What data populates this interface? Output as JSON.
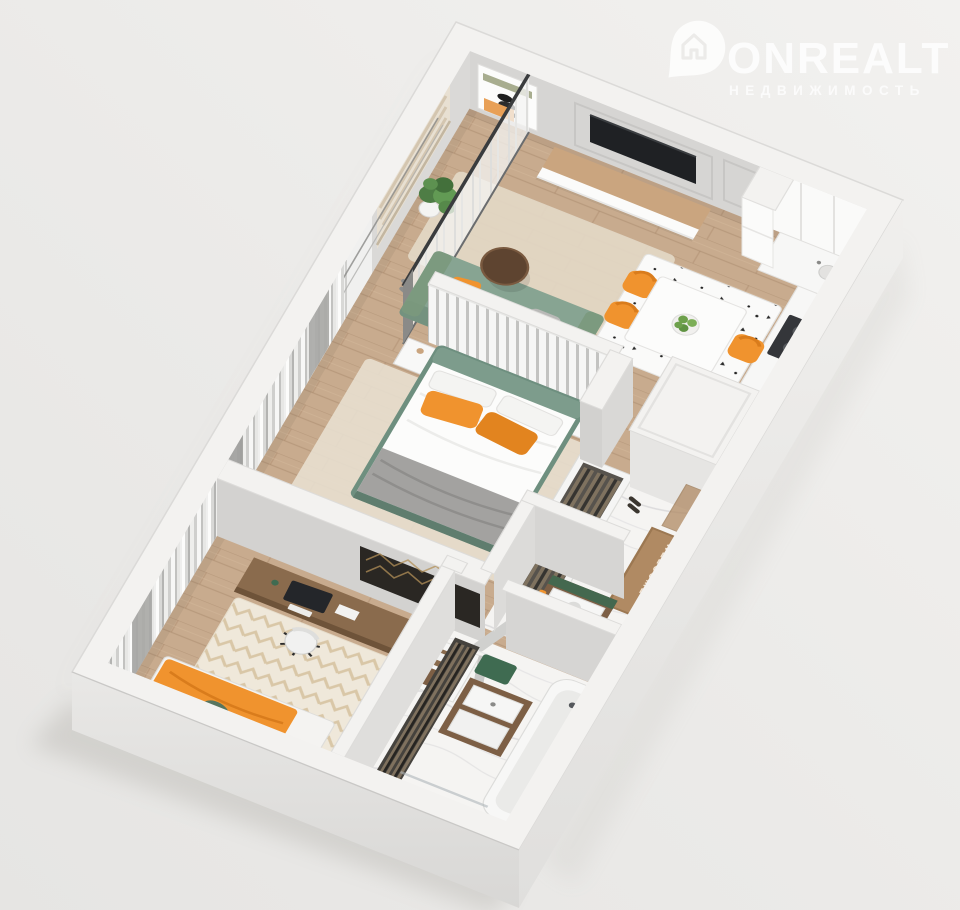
{
  "watermark": {
    "brand": "ONREALT",
    "tagline": "НЕДВИЖИМОСТЬ",
    "icon": "house-pin-icon"
  },
  "labels": {
    "doormat": "WELCOME",
    "doormat_reflection": "WELCOME"
  },
  "scene": {
    "type": "3d-floor-plan-render",
    "view": "isometric top-down, rotated",
    "background": "#edecea",
    "rooms": [
      {
        "id": "balcony",
        "name": "glazed loggia",
        "items": [
          "roman-blind-windows",
          "potted-plant",
          "wall-art",
          "slippers",
          "sheer-glazing-partition"
        ]
      },
      {
        "id": "living-kitchen",
        "name": "living room + kitchen",
        "items": [
          "wall-tv",
          "tv-stand",
          "molding-wall-panels",
          "green-sofa",
          "orange-cushions",
          "round-coffee-table-orange-base",
          "beige-rug",
          "white-dining-table",
          "plate-of-green-apples",
          "three-orange-chairs",
          "speckled-rug",
          "white-kitchen-cabinets",
          "dark-cooktop",
          "tall-fridge-column",
          "arc-floor-lamp"
        ]
      },
      {
        "id": "master-bedroom",
        "name": "bedroom",
        "items": [
          "green-double-bed",
          "white-duvet",
          "gray-throw",
          "two-orange-pillows",
          "slatted-partition",
          "two-white-nightstands",
          "open-wardrobe-with-clothes",
          "leaning-tv",
          "sheer-and-gray-curtains"
        ]
      },
      {
        "id": "office-bedroom",
        "name": "kids room / office",
        "items": [
          "walnut-desk",
          "monitor",
          "office-chair",
          "media-console",
          "herringbone-tv-art",
          "chevron-rug",
          "single-bed-orange-blanket",
          "green-pillow"
        ]
      },
      {
        "id": "hallway-entry",
        "name": "entry hall",
        "items": [
          "bronze-mirror-wardrobe",
          "welcome-doormat",
          "marble-floor",
          "entry-door"
        ]
      },
      {
        "id": "laundry-closet",
        "name": "utility closet",
        "items": [
          "stacked-white-appliances",
          "walnut-frame",
          "orange-towel",
          "green-top"
        ]
      },
      {
        "id": "bathroom",
        "name": "bathroom",
        "items": [
          "bathtub",
          "shower-set",
          "glass-screen",
          "walnut-vanity-double-basin",
          "clothes-rail",
          "green-bath-mats",
          "toilet",
          "marble-floor"
        ]
      }
    ]
  },
  "palette": {
    "background": "#edecea",
    "wall_top": "#f3f2f0",
    "wall_face": "#d6d5d3",
    "wall_face_light": "#e3e2e0",
    "wall_outer": "#e7e6e4",
    "floor_wood": "#c8ab8e",
    "wood_line": "#9b7c5d",
    "floor_marble": "#f5f4f2",
    "marble_vein": "#b9b9bf",
    "rug_beige": "#e3d8c5",
    "rug_cream": "#efe8da",
    "chevron_tan": "#d8c3a2",
    "accent_orange": "#f0932e",
    "orange_deep": "#d97c1c",
    "sofa_green": "#87a492",
    "headboard_green": "#6e8f7f",
    "dark_green": "#3f6b51",
    "walnut": "#7d5f45",
    "walnut_light": "#caa57f",
    "screen_black": "#1f2124",
    "mirror_bronze": "#857563",
    "curtain_gray": "#a7a7a5",
    "mat_brown": "#b08a63",
    "white": "#ffffff"
  }
}
